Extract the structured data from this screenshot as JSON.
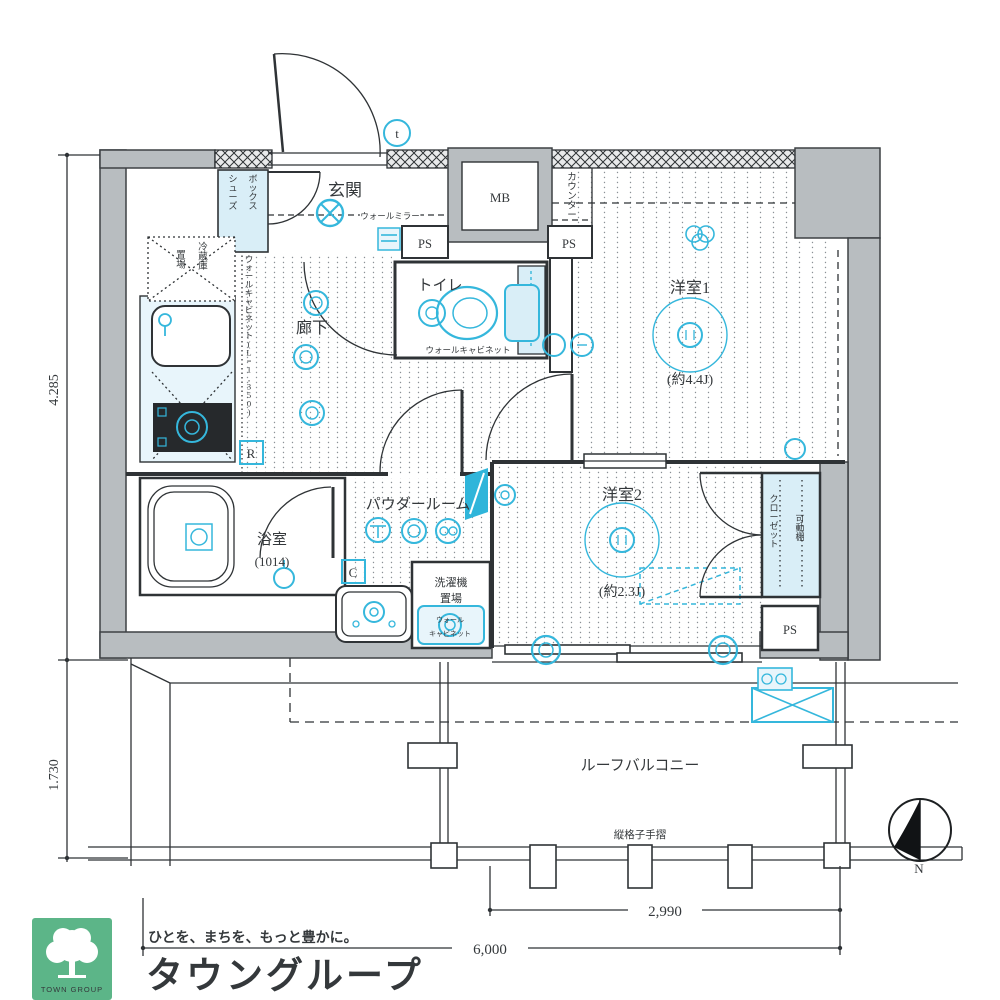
{
  "plan": {
    "rooms": {
      "entrance": "玄関",
      "hallway": "廊下",
      "toilet": "トイレ",
      "western1": "洋室1",
      "western1_size": "(約4.4J)",
      "western2": "洋室2",
      "western2_size": "(約2.3J)",
      "bath": "浴室",
      "bath_size": "(1014)",
      "powder_room": "パウダールーム",
      "closet": "クローゼット",
      "movable_shelf": "可動棚",
      "roof_balcony": "ルーフバルコニー"
    },
    "fixtures": {
      "shoes_box_col1": "シューズ",
      "shoes_box_col2": "ボックス",
      "wall_mirror": "ウォールミラー",
      "meter_box": "MB",
      "pipe_space": "PS",
      "counter": "カウンター",
      "toilet_wall_cabinet": "ウォールキャビネット",
      "kitchen_wall_cabinet": "ウォールキャビネット(L=1,350)",
      "fridge_col1": "冷蔵庫",
      "fridge_col2": "置場",
      "washer_line1": "洗濯機",
      "washer_line2": "置場",
      "washer_cabinet_line1": "ウォール",
      "washer_cabinet_line2": "キャビネット",
      "lattice_handrail": "縦格子手摺"
    },
    "symbols": {
      "r": "R",
      "c": "C",
      "t": "t"
    },
    "dimensions": {
      "left_upper": "4.285",
      "left_lower": "1.730",
      "bottom_inner": "2,990",
      "bottom_outer": "6,000"
    },
    "compass": {
      "north": "N"
    }
  },
  "logo": {
    "group_name_en": "TOWN GROUP",
    "tagline": "ひとを、まちを、もっと豊かに。",
    "brand": "タウングループ"
  },
  "colors": {
    "accent_cyan": "#35b7dc",
    "wall_gray": "#b8bdc0",
    "logo_green": "#5cb588"
  }
}
